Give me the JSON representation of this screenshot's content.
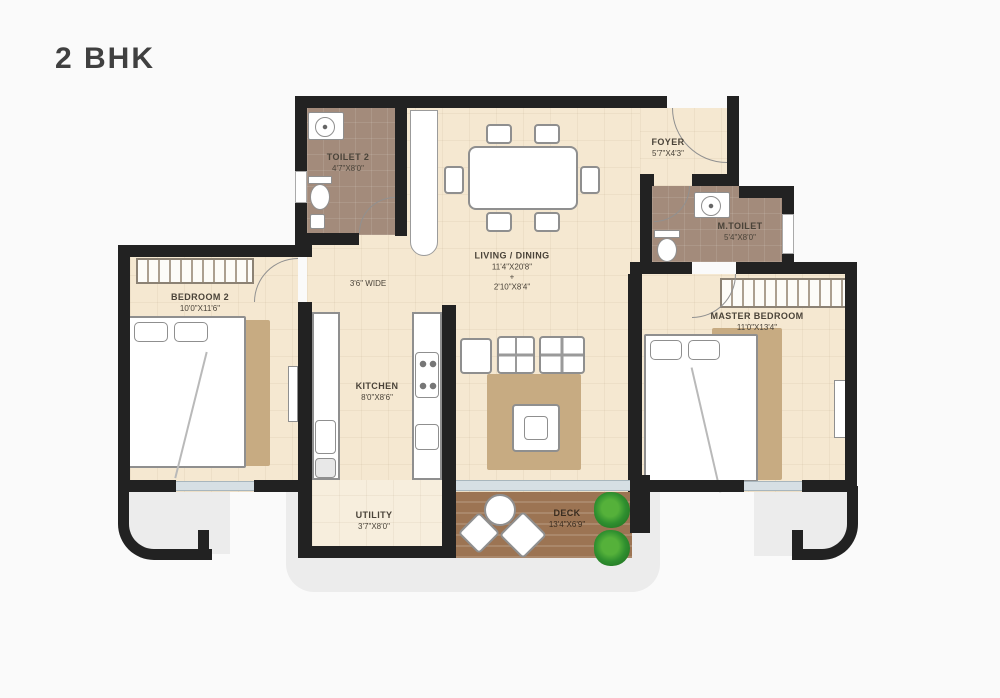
{
  "title": "2 BHK",
  "rooms": {
    "toilet2": {
      "name": "TOILET 2",
      "dims": "4'7\"X8'0\""
    },
    "foyer": {
      "name": "FOYER",
      "dims": "5'7\"X4'3\""
    },
    "living": {
      "name": "LIVING / DINING",
      "dims": "11'4\"X20'8\"",
      "plus": "+",
      "dims2": "2'10\"X8'4\""
    },
    "passage": {
      "dims": "3'6\" WIDE"
    },
    "bedroom2": {
      "name": "BEDROOM 2",
      "dims": "10'0\"X11'6\""
    },
    "master": {
      "name": "MASTER BEDROOM",
      "dims": "11'0\"X13'4\""
    },
    "mtoilet": {
      "name": "M.TOILET",
      "dims": "5'4\"X8'0\""
    },
    "kitchen": {
      "name": "KITCHEN",
      "dims": "8'0\"X8'6\""
    },
    "utility": {
      "name": "UTILITY",
      "dims": "3'7\"X8'0\""
    },
    "deck": {
      "name": "DECK",
      "dims": "13'4\"X6'9\""
    }
  },
  "colors": {
    "wall": "#222222",
    "floor": "#f5e8d1",
    "wet_floor": "#a38b7b",
    "rug": "#c7ab82",
    "deck_wood": "#9c7453",
    "plant_green": "#2f8f2f",
    "glass": "#d6dfe4",
    "apron_gray": "#ececec",
    "label_text": "#4a4339"
  }
}
